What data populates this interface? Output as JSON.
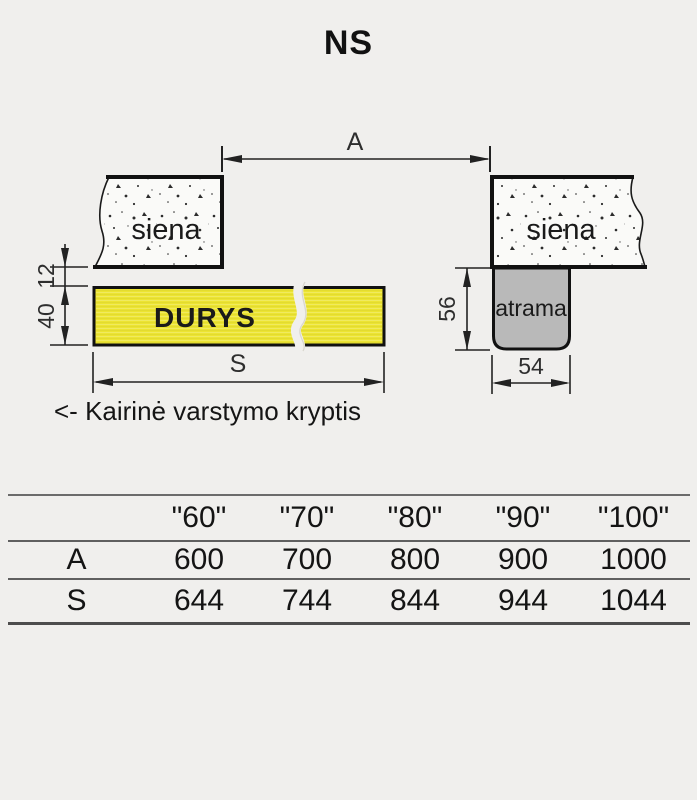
{
  "title": "NS",
  "diagram": {
    "dim_a_label": "A",
    "dim_s_label": "S",
    "dim_12": "12",
    "dim_40": "40",
    "dim_56": "56",
    "dim_54": "54",
    "left_wall_label": "siena",
    "right_wall_label": "siena",
    "door_label": "DURYS",
    "support_label": "atrama",
    "colors": {
      "background": "#f0efed",
      "door_fill": "#ece432",
      "support_fill": "#b9b9b9",
      "wall_fill": "#fafaf8",
      "line": "#111111"
    }
  },
  "caption": "<- Kairinė varstymo kryptis",
  "table": {
    "columns": [
      "\"60\"",
      "\"70\"",
      "\"80\"",
      "\"90\"",
      "\"100\""
    ],
    "rows": [
      {
        "label": "A",
        "values": [
          "600",
          "700",
          "800",
          "900",
          "1000"
        ]
      },
      {
        "label": "S",
        "values": [
          "644",
          "744",
          "844",
          "944",
          "1044"
        ]
      }
    ]
  }
}
